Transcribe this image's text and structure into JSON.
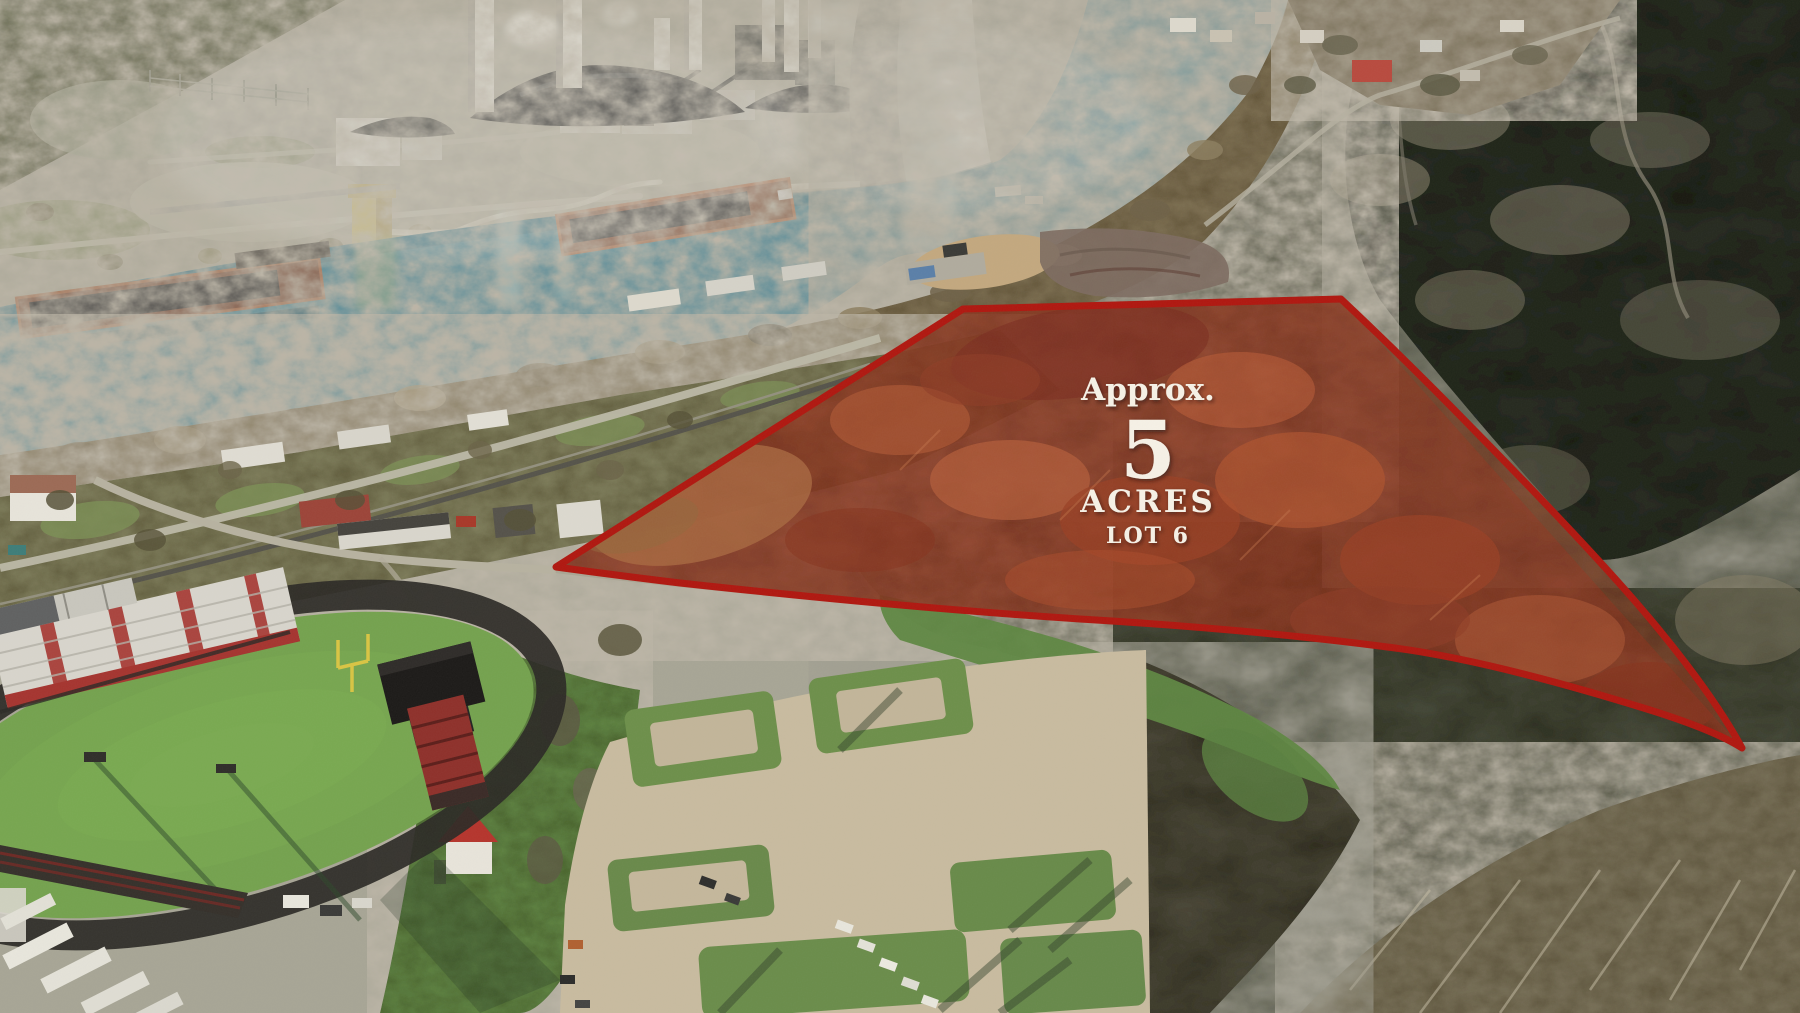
{
  "overlay": {
    "approx_label": "Approx.",
    "acres_value": "5",
    "acres_label": "ACRES",
    "lot_label": "LOT 6",
    "text_color": "#f6f1e6",
    "outline_color": "#b0170f",
    "tint_fill": "rgba(190,35,18,0.22)"
  },
  "scene": {
    "water_color": "#2e7a92",
    "field_color": "#74a24e",
    "track_color": "#2b2925",
    "pavement_color": "#c8bb9f",
    "forest_base_color": "#4a4e3c",
    "forest_shadow_color": "#272c22",
    "coal_color": "#131517",
    "cooling_tower_shade": "#8f8d83",
    "landmarks": [
      "power plant",
      "cooling tower",
      "smokestacks",
      "coal piles",
      "river",
      "barges",
      "railroad",
      "riverside houses",
      "football field",
      "running track",
      "grandstand",
      "scoreboard",
      "parking lots",
      "red roof hut",
      "wooded hillside",
      "highlighted parcel"
    ]
  }
}
